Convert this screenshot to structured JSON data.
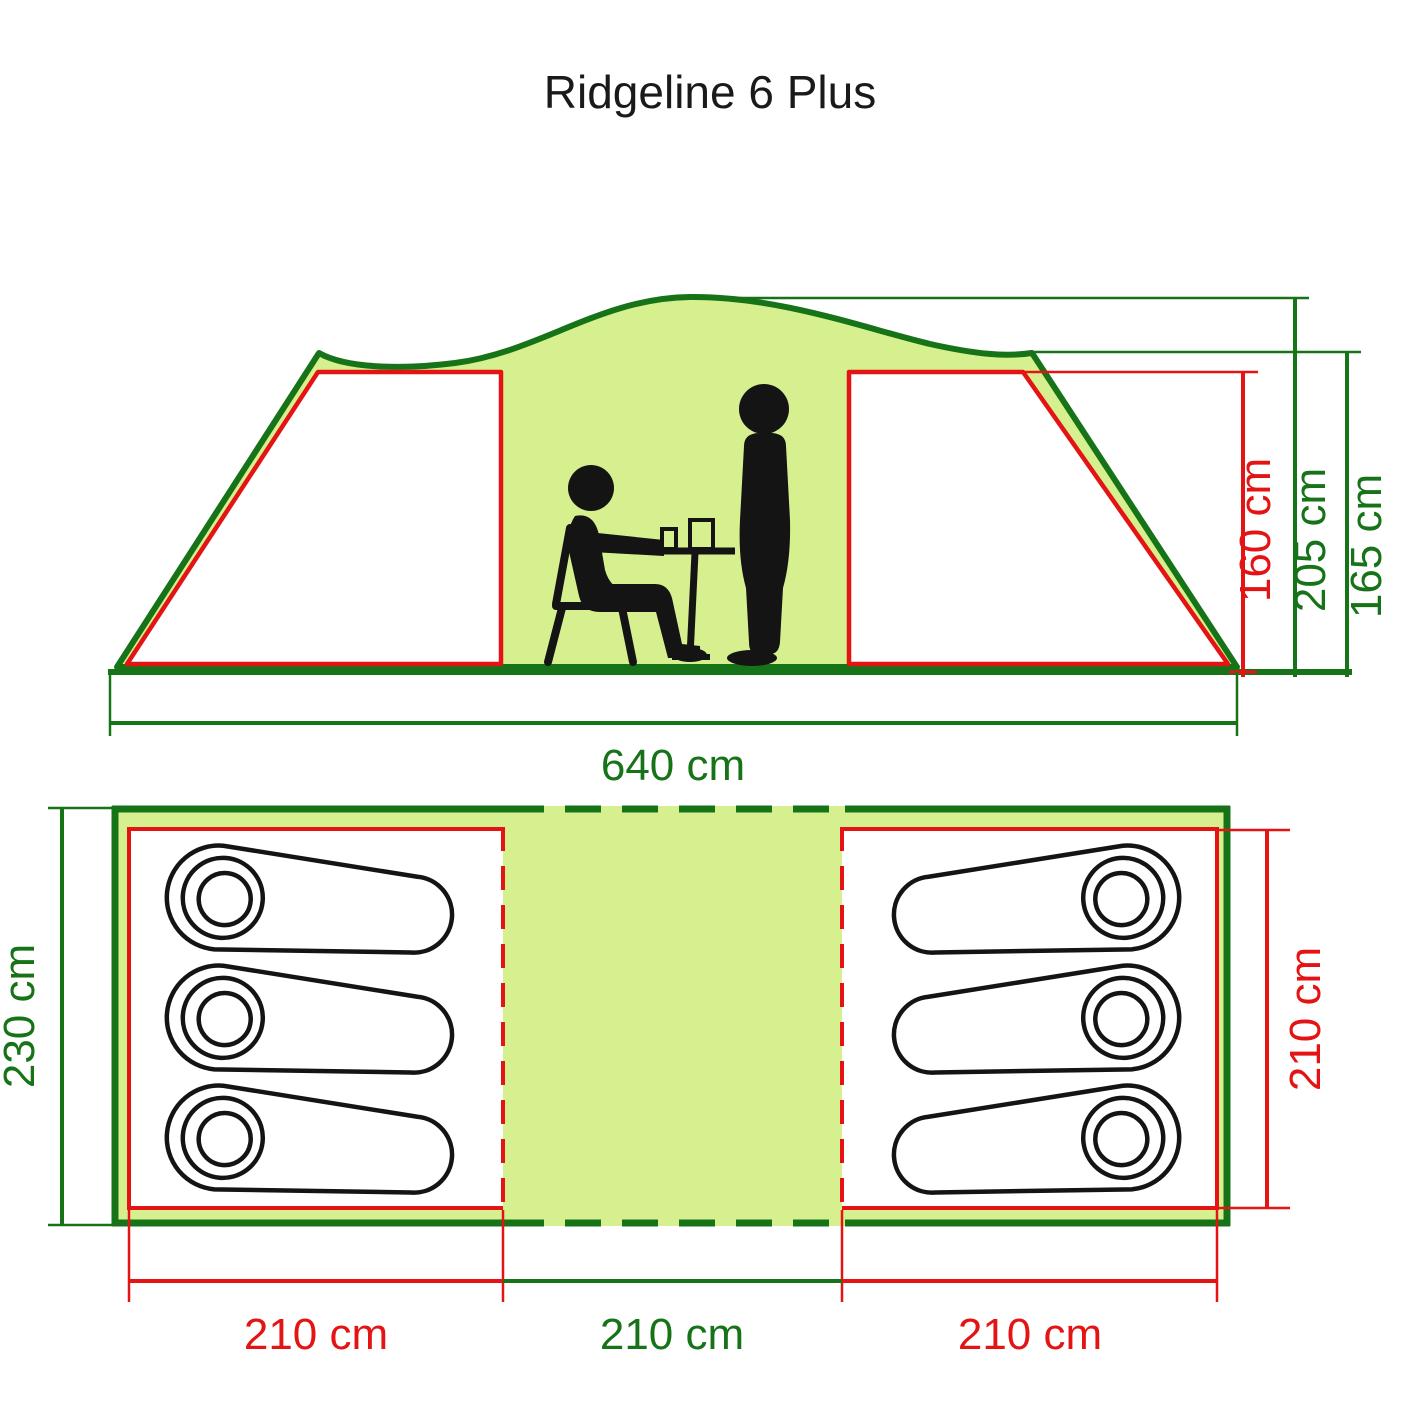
{
  "title": "Ridgeline 6 Plus",
  "colors": {
    "line_green": "#177317",
    "fill_green": "#d7f08f",
    "dimension_red": "#e41414",
    "figure_black": "#141414",
    "bedroom_fill": "#ffffff"
  },
  "elevation": {
    "inner_height": "160 cm",
    "peak_height": "205 cm",
    "shoulder_height": "165 cm",
    "total_width": "640 cm"
  },
  "plan": {
    "total_depth": "230 cm",
    "bedroom_depth": "210 cm",
    "left_bedroom_width": "210 cm",
    "living_width": "210 cm",
    "right_bedroom_width": "210 cm"
  }
}
